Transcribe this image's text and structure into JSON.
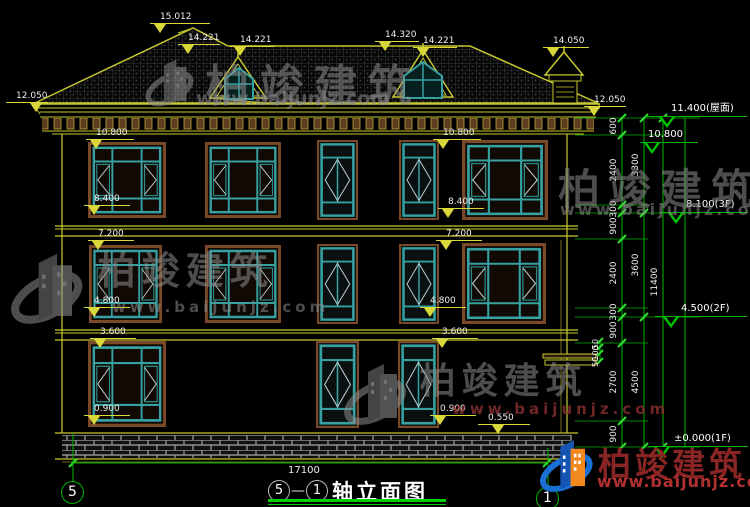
{
  "brand": {
    "name": "柏竣建筑",
    "url": "www.baijunjz.com"
  },
  "titleblock": {
    "axis_start": "5",
    "separator": "—",
    "axis_end": "1",
    "title": "轴立面图",
    "total_width_dim": "17100"
  },
  "axis_bubbles": {
    "left": "5",
    "right": "1"
  },
  "elevations": {
    "facade": [
      "15.012",
      "14.221",
      "14.221",
      "14.320",
      "14.221",
      "14.050",
      "12.050",
      "12.050",
      "10.800",
      "10.800",
      "8.400",
      "8.400",
      "7.200",
      "7.200",
      "4.800",
      "4.800",
      "3.600",
      "3.600",
      "0.900",
      "0.900",
      "0.550"
    ],
    "levels": [
      "11.400(屋面)",
      "10.800",
      "8.100(3F)",
      "4.500(2F)",
      "±0.000(1F)"
    ]
  },
  "dims": {
    "chain_inner": [
      "600",
      "2400",
      "300",
      "900",
      "2400",
      "300",
      "900",
      "2700",
      "900"
    ],
    "chain_mid": [
      "3300",
      "3600",
      "4500"
    ],
    "chain_outer": [
      "11400"
    ],
    "chain_canopy": [
      "50",
      "100",
      "50"
    ]
  }
}
